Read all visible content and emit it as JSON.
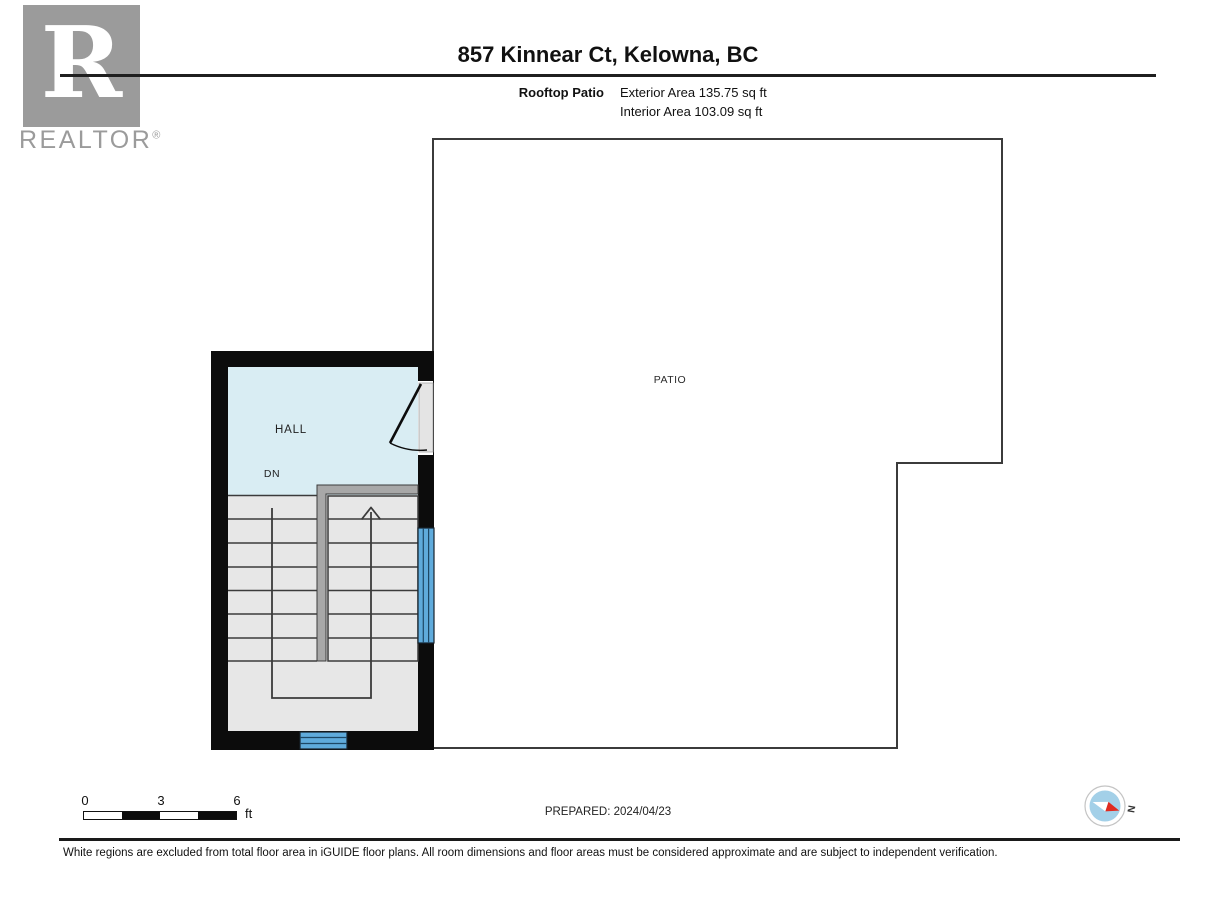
{
  "header": {
    "title": "857 Kinnear Ct, Kelowna, BC",
    "floor_label": "Rooftop Patio",
    "exterior_area": "Exterior Area 135.75 sq ft",
    "interior_area": "Interior Area 103.09 sq ft",
    "logo_letter": "R",
    "logo_text": "REALTOR",
    "logo_registered": "®"
  },
  "plan": {
    "patio_label": "PATIO",
    "hall_label": "HALL",
    "down_label": "DN"
  },
  "footer": {
    "scale_ticks": [
      "0",
      "3",
      "6"
    ],
    "scale_unit": "ft",
    "prepared": "PREPARED: 2024/04/23",
    "compass_north": "N",
    "disclaimer": "White regions are excluded from total floor area in iGUIDE floor plans. All room dimensions and floor areas must be considered approximate and are subject to independent verification."
  },
  "colors": {
    "wall_black": "#0c0c0c",
    "thin_line": "#3b3b3b",
    "hall_fill": "#d9edf3",
    "stair_fill": "#e7e7e7",
    "railing_gray": "#a8a8a8",
    "window_blue": "#5fabdc",
    "logo_gray": "#9b9b9b",
    "compass_blue": "#a3d0e8",
    "compass_red": "#e02b20"
  }
}
